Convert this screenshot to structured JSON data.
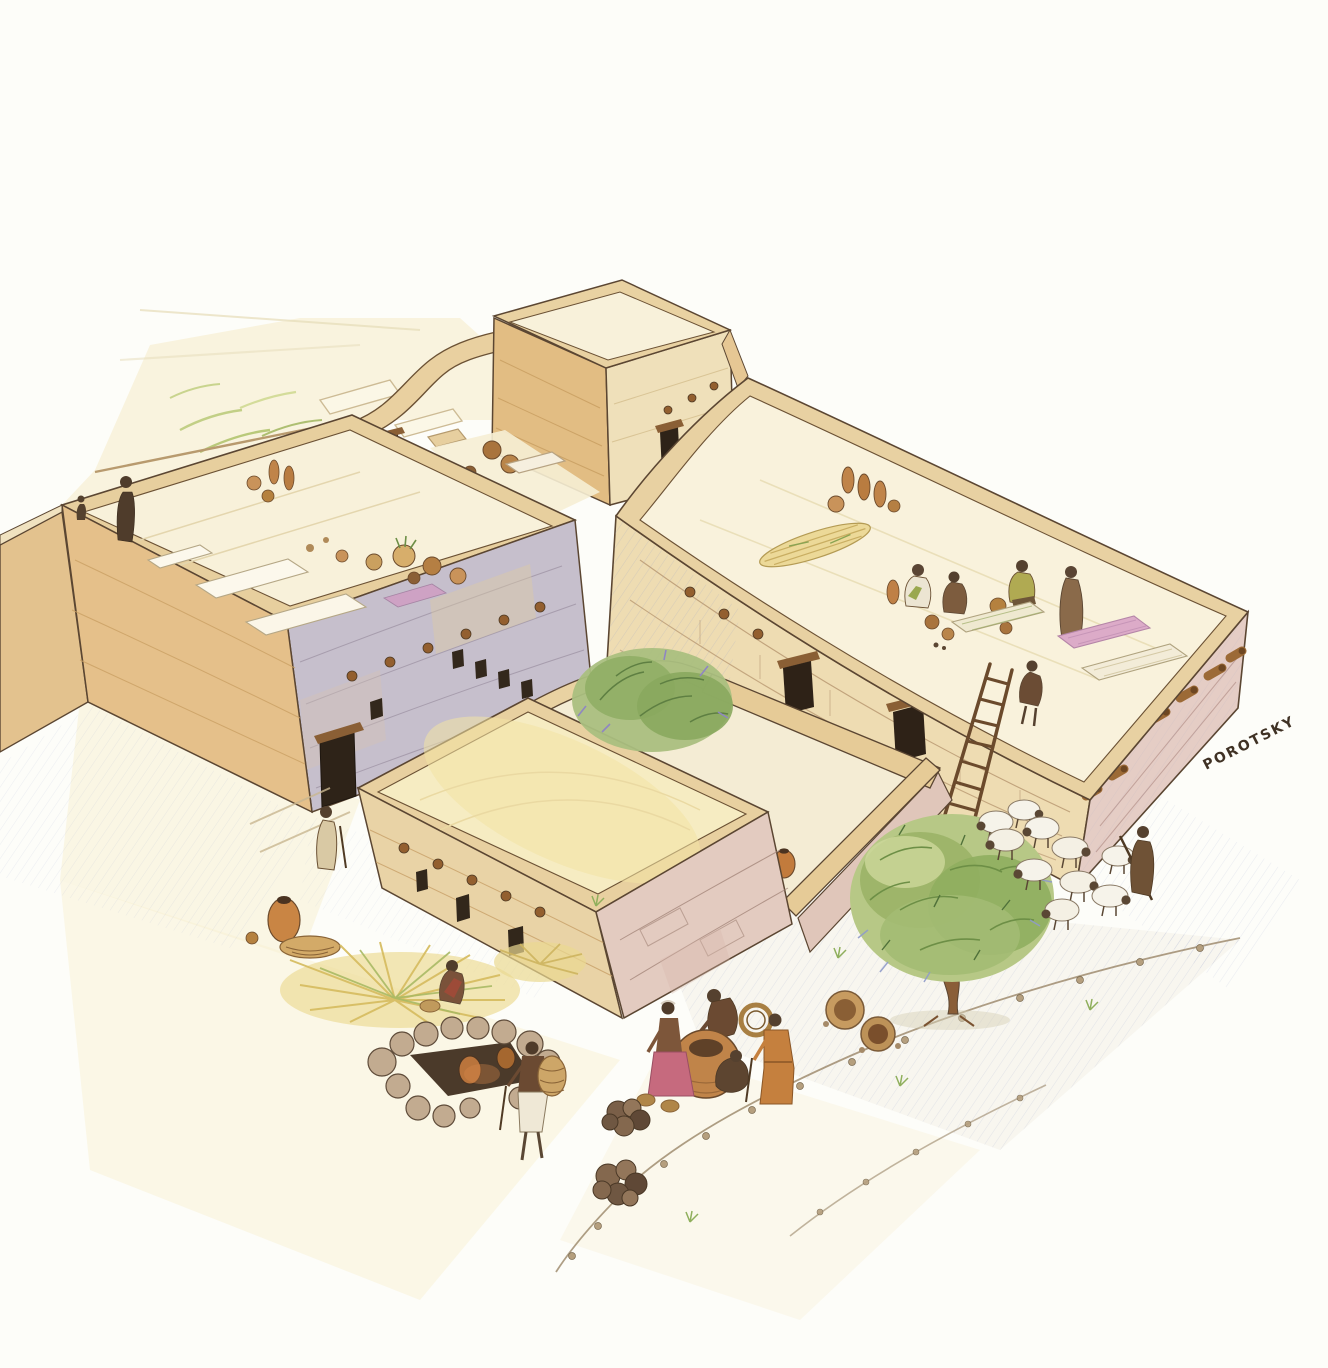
{
  "illustration": {
    "signature": "POROTSKY",
    "palette": {
      "paper": "#fdfdf9",
      "roof_cream": "#f8f1da",
      "roof_yellow": "#f3e4a4",
      "wall_sand": "#e8cfa2",
      "wall_orange": "#e2bd83",
      "wall_blue_gray": "#c6bfcc",
      "wall_pink": "#e5cdc5",
      "ink": "#5b4632",
      "clay_orange": "#c98544",
      "beam_brown": "#935f2f",
      "vegetation_green": "#94b061",
      "shadow_blue": "#8f9bc9",
      "figure_brown": "#6b4a32",
      "robe_orange": "#c5803e",
      "robe_pink": "#c66a7e",
      "mat_purple": "#cf9fc4",
      "sheep_wool": "#f6f3ea"
    },
    "scene_elements": [
      "flat-roofed-stone-house-left",
      "flat-roofed-stone-house-right",
      "watchtower",
      "front-house-with-courtyard",
      "rooftop-figures",
      "rooftop-storage-jars",
      "grain-sheaf",
      "sleeping-mats",
      "wooden-ladder",
      "courtyard-jars",
      "courtyard-shrub",
      "olive-tree",
      "sheep-flock",
      "shepherd",
      "tabun-clay-oven",
      "stone-kiln",
      "hay-piles",
      "villagers-on-street",
      "street-with-stone-edges"
    ]
  }
}
